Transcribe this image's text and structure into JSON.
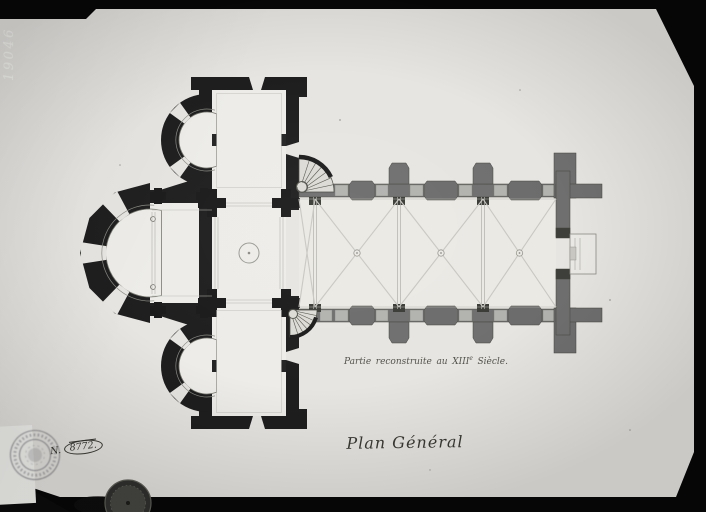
{
  "photo_plate": {
    "plate_number": "19046",
    "background_color": "#070707",
    "paper_color": "#e7e5e1",
    "label_color": "#f4f4f1"
  },
  "drawing": {
    "title": "Plan Général",
    "annotation": {
      "words": [
        "Partie",
        "reconstruite",
        "au"
      ],
      "century": "XIII",
      "century_sup": "e",
      "suffix": "Siècle."
    },
    "inventory": {
      "prefix": "N.",
      "number": "8772."
    },
    "colors": {
      "romanesque_walls": "#1e1e1e",
      "thirteenth_century_walls": "#6f6f6f",
      "window_openings": "#b2b2af",
      "interior_floor": "#edece8",
      "thin_lines": "#9a9a97"
    }
  }
}
